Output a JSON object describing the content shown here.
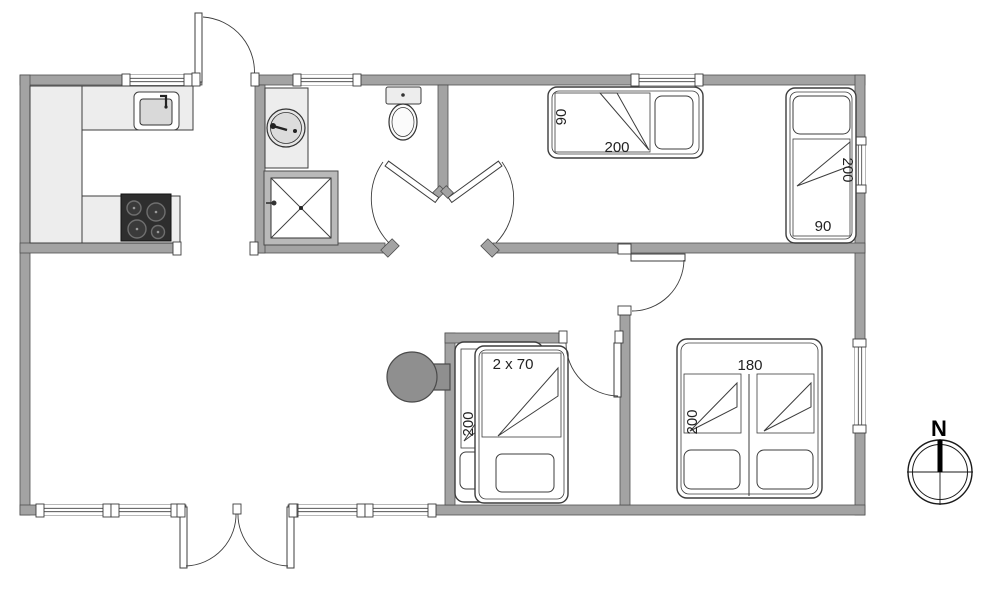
{
  "labels": {
    "bed1": {
      "width": "90",
      "length": "200"
    },
    "bed2": {
      "length": "200",
      "width": "90"
    },
    "bunk": {
      "size": "2 x 70",
      "length": "200"
    },
    "double": {
      "width": "180",
      "length": "200"
    }
  },
  "compass": {
    "north": "N"
  },
  "colors": {
    "wall": "#a3a3a3",
    "wall_outline": "#4f4f4f",
    "fixture_fill": "#ededed",
    "cooktop": "#2e2e2e",
    "wood_stove": "#8f8f8f",
    "line": "#3d3d3d",
    "background": "#ffffff"
  }
}
